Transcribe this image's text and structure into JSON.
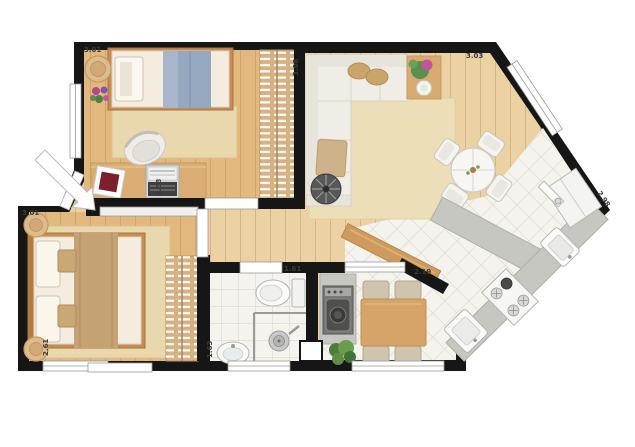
{
  "floorplan": {
    "type": "apartment-floor-plan-top-view",
    "dimension_labels": {
      "bedroom1_width": "3.01",
      "bedroom1_depth": "2.58",
      "living_depth": "3.08",
      "living_width": "3.03",
      "kitchen_wall": "2.98",
      "master_width": "3.01",
      "master_depth": "2.61",
      "bathroom_width": "1.61",
      "bathroom_depth": "1.63",
      "dining_width": "2.19"
    },
    "colors": {
      "wall": "#161616",
      "wood_floor": "#e2b87e",
      "wood_floor_light": "#ecd2a2",
      "tile_floor": "#f5f3ee",
      "rug": "#e9d8ad",
      "counter": "#c6c7c1",
      "sofa": "#efede6",
      "accent_wood": "#d6a468",
      "bar_wood": "#cf9a5e",
      "blanket_blue": "#96a7c0",
      "blanket_tan": "#c4a273",
      "cushion_red": "#7d1f2d",
      "wardrobe": "#d6b183",
      "plant_green": "#5a8f4f"
    },
    "furniture": [
      "single-bed",
      "desk",
      "desk-chair",
      "laptop",
      "red-cushion",
      "nightstand",
      "flower-vase",
      "wardrobe",
      "l-shaped-sofa",
      "pouf",
      "floor-fan",
      "console-table",
      "round-dining-table",
      "white-chairs",
      "area-rug",
      "double-bed",
      "nightstands",
      "wardrobe-2",
      "toilet",
      "bathroom-sink",
      "shower",
      "washing-machine",
      "potted-plant",
      "wood-dining-table",
      "wood-chairs",
      "kitchen-counter",
      "island-counter",
      "breakfast-bar",
      "stove",
      "kitchen-sink",
      "laundry-tub",
      "refrigerator",
      "entry-arrow"
    ]
  }
}
